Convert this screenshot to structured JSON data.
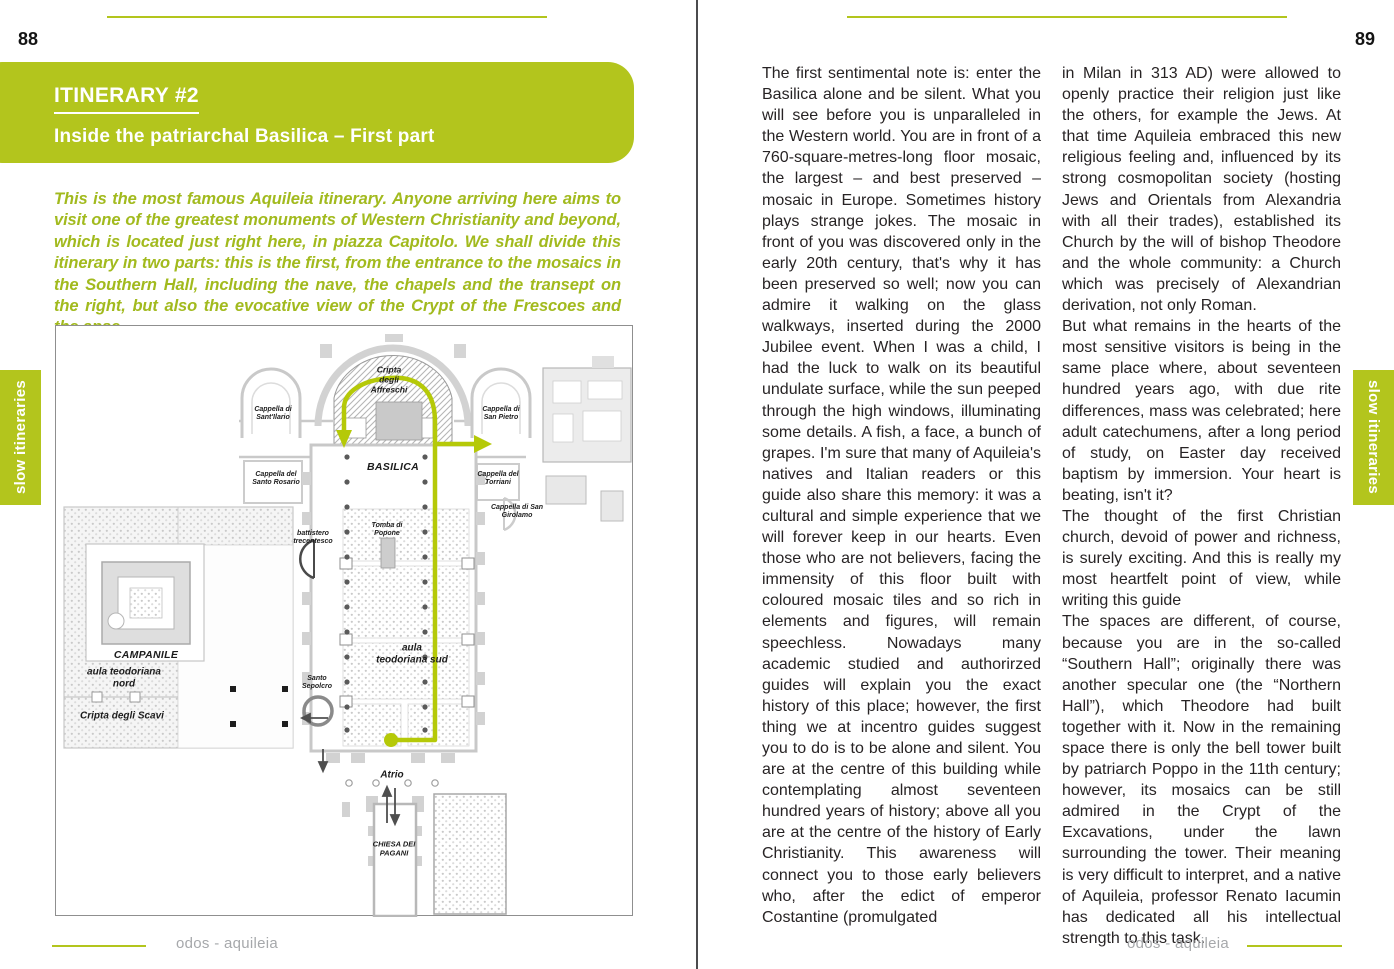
{
  "colors": {
    "accent_green": "#b3c51d",
    "route_green": "#b5c908",
    "intro_green": "#a2ba1e",
    "body_text": "#272324",
    "footer_gray": "#a6a8ab"
  },
  "left_page": {
    "page_number": "88",
    "side_tab": "slow itineraries",
    "header": {
      "title": "ITINERARY #2",
      "subtitle": "Inside the patriarchal Basilica – First part"
    },
    "intro": "This is the most famous Aquileia itinerary.  Anyone arriving here aims to visit one of the greatest monuments of Western Christianity and beyond, which is located just right here, in piazza Capitolo.  We shall divide this itinerary in two parts: this is the first, from the entrance to the mosaics in the Southern Hall, including the nave, the chapels and the transept on the right, but also the evocative view of the Crypt of the Frescoes and the apse.",
    "map": {
      "labels": {
        "cripta_affreschi": "Cripta degli Affreschi",
        "cappella_sant_ilario": "Cappella di Sant'Ilario",
        "cappella_san_pietro": "Cappella di San Pietro",
        "basilica": "BASILICA",
        "cappella_santo_rosario": "Cappella del Santo Rosario",
        "cappella_torriani": "Cappella del Torriani",
        "cappella_san_girolamo": "Cappella di San Girolamo",
        "battistero": "battistero trecentesco",
        "tomba_popone": "Tomba di Popone",
        "aula_sud": "aula teodoriana sud",
        "campanile": "CAMPANILE",
        "aula_nord": "aula teodoriana nord",
        "cripta_scavi": "Cripta degli Scavi",
        "santo_sepolcro": "Santo Sepolcro",
        "atrio": "Atrio",
        "chiesa_pagani": "CHIESA DEI PAGANI"
      }
    },
    "footer": "odos - aquileia"
  },
  "right_page": {
    "page_number": "89",
    "side_tab": "slow itineraries",
    "column1": "The first sentimental note is: enter the Basilica alone and be silent.  What you will see before you is unparalleled in the Western world.  You are in front of a 760-square-metres-long floor mosaic, the largest – and best preserved – mosaic in Europe.  Sometimes history plays strange jokes. The mosaic in front of you was discovered only in the early 20th century, that's why it has been preserved so well; now you can admire it walking on the glass walkways, inserted during the 2000 Jubilee event. When I was a child, I had the luck to walk on its beautiful undulate surface, while the sun peeped through the high windows, illuminating some details. A fish, a face, a bunch of grapes. I'm sure that many of Aquileia's natives and Italian readers or this guide also share this memory: it was a cultural and simple experience that we will forever keep in our hearts.  Even those who are not believers, facing the immensity of this floor built with coloured mosaic tiles and so rich in elements and figures, will remain speechless. Nowadays many academic studied and authorirzed guides will explain you the exact history of this place; however, the first thing we at incentro guides suggest you to do is to be alone and silent. You are at the centre of this building while contemplating almost seventeen hundred years of history; above all you are at the centre of the history of Early Christianity. This awareness will connect you to those early believers who, after the edict of emperor Costantine (promulgated",
    "column2": [
      "in Milan in 313 AD) were allowed to openly practice their religion just like the others, for example the Jews. At that time Aquileia embraced this new religious feeling and, influenced by its strong cosmopolitan society (hosting Jews and Orientals from Alexandria with all their trades), established its Church by the will of bishop Theodore and the whole community: a Church which was precisely of Alexandrian derivation, not only Roman.",
      "But what remains in the hearts of the most sensitive visitors is being in the same place where, about seventeen hundred years ago, with due rite differences, mass was celebrated; here adult catechumens, after a long period of study, on Easter day received baptism by immersion. Your heart is beating, isn't it?",
      "The thought of the first Christian church, devoid of power and richness, is surely exciting. And this is really my most heartfelt point of view, while writing this guide",
      "The spaces are different, of course, because you are in the so-called “Southern Hall”; originally there was another specular one (the “Northern Hall”), which Theodore had built together with it. Now in the remaining space there is only the bell tower built by patriarch Poppo in the 11th century; however, its mosaics can be still admired in the Crypt of the Excavations, under the lawn surrounding the tower. Their meaning is very difficult to interpret, and a native of Aquileia, professor Renato Iacumin has dedicated all his intellectual strength to this task."
    ],
    "footer": "odos - aquileia"
  }
}
